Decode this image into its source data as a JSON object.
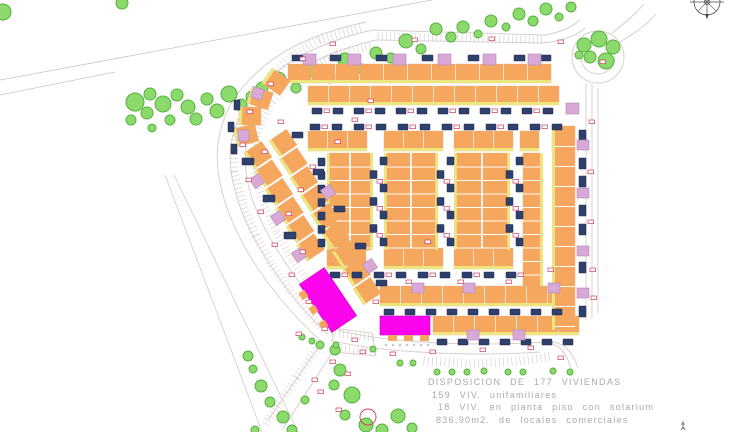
{
  "title_block": {
    "line1": "DISPOSICION  DE  177  VIVIENDAS",
    "line2": "159  VIV.  unifamiliares",
    "line3": "18  VIV.  en  planta  piso  con  solarium",
    "line4": "836,90m2.  de  locales  comerciales"
  },
  "figures": {
    "total_viviendas": "177",
    "viviendas_unifamiliares": "159",
    "viviendas_planta_piso_solarium": "18",
    "locales_comerciales_m2": "836,90"
  },
  "icons": {
    "compass": "compass-rose"
  },
  "colors": {
    "house_orange": "#F5A75D",
    "house_outline": "#E3B077",
    "yellow_strip": "#EDE57E",
    "pool_navy": "#30406C",
    "pool_outline": "#1C2A4D",
    "pink_square": "#D8A8D6",
    "pink_outline": "#B487B2",
    "magenta_commercial": "#FB03EC",
    "magenta_outline": "#C400BC",
    "tree_green": "#8CD96C",
    "tree_outline": "#55B13F",
    "red_label": "#CC3B5E",
    "road_line": "#D8CBCB",
    "hatch_line": "#CDBFBF",
    "boundary_line": "#C9C4C4",
    "compass_ink": "#4A4A4A",
    "legend_text": "#A9A9A9"
  }
}
